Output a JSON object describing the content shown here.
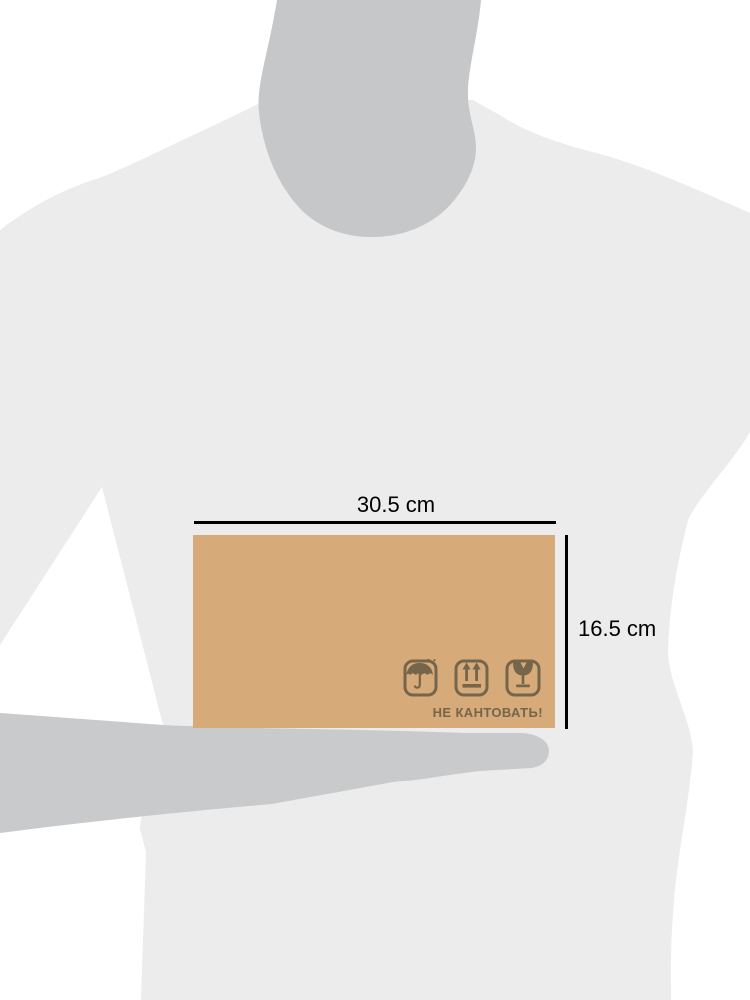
{
  "illustration": {
    "type": "package-size-comparison-diagram",
    "dimensions": {
      "width_label": "30.5 cm",
      "height_label": "16.5 cm",
      "line_color": "#000000"
    },
    "box": {
      "caption": "НЕ КАНТОВАТЬ!",
      "color": "#d6aa79",
      "marking_color": "#75654a",
      "icons": [
        {
          "name": "keep-dry-umbrella-icon"
        },
        {
          "name": "this-side-up-arrows-icon"
        },
        {
          "name": "fragile-glass-icon"
        }
      ]
    },
    "silhouette": {
      "background_color": "#ffffff",
      "shirt_color": "#ececec",
      "head_color": "#c6c7c8",
      "arm_color": "#c9cacb"
    }
  }
}
